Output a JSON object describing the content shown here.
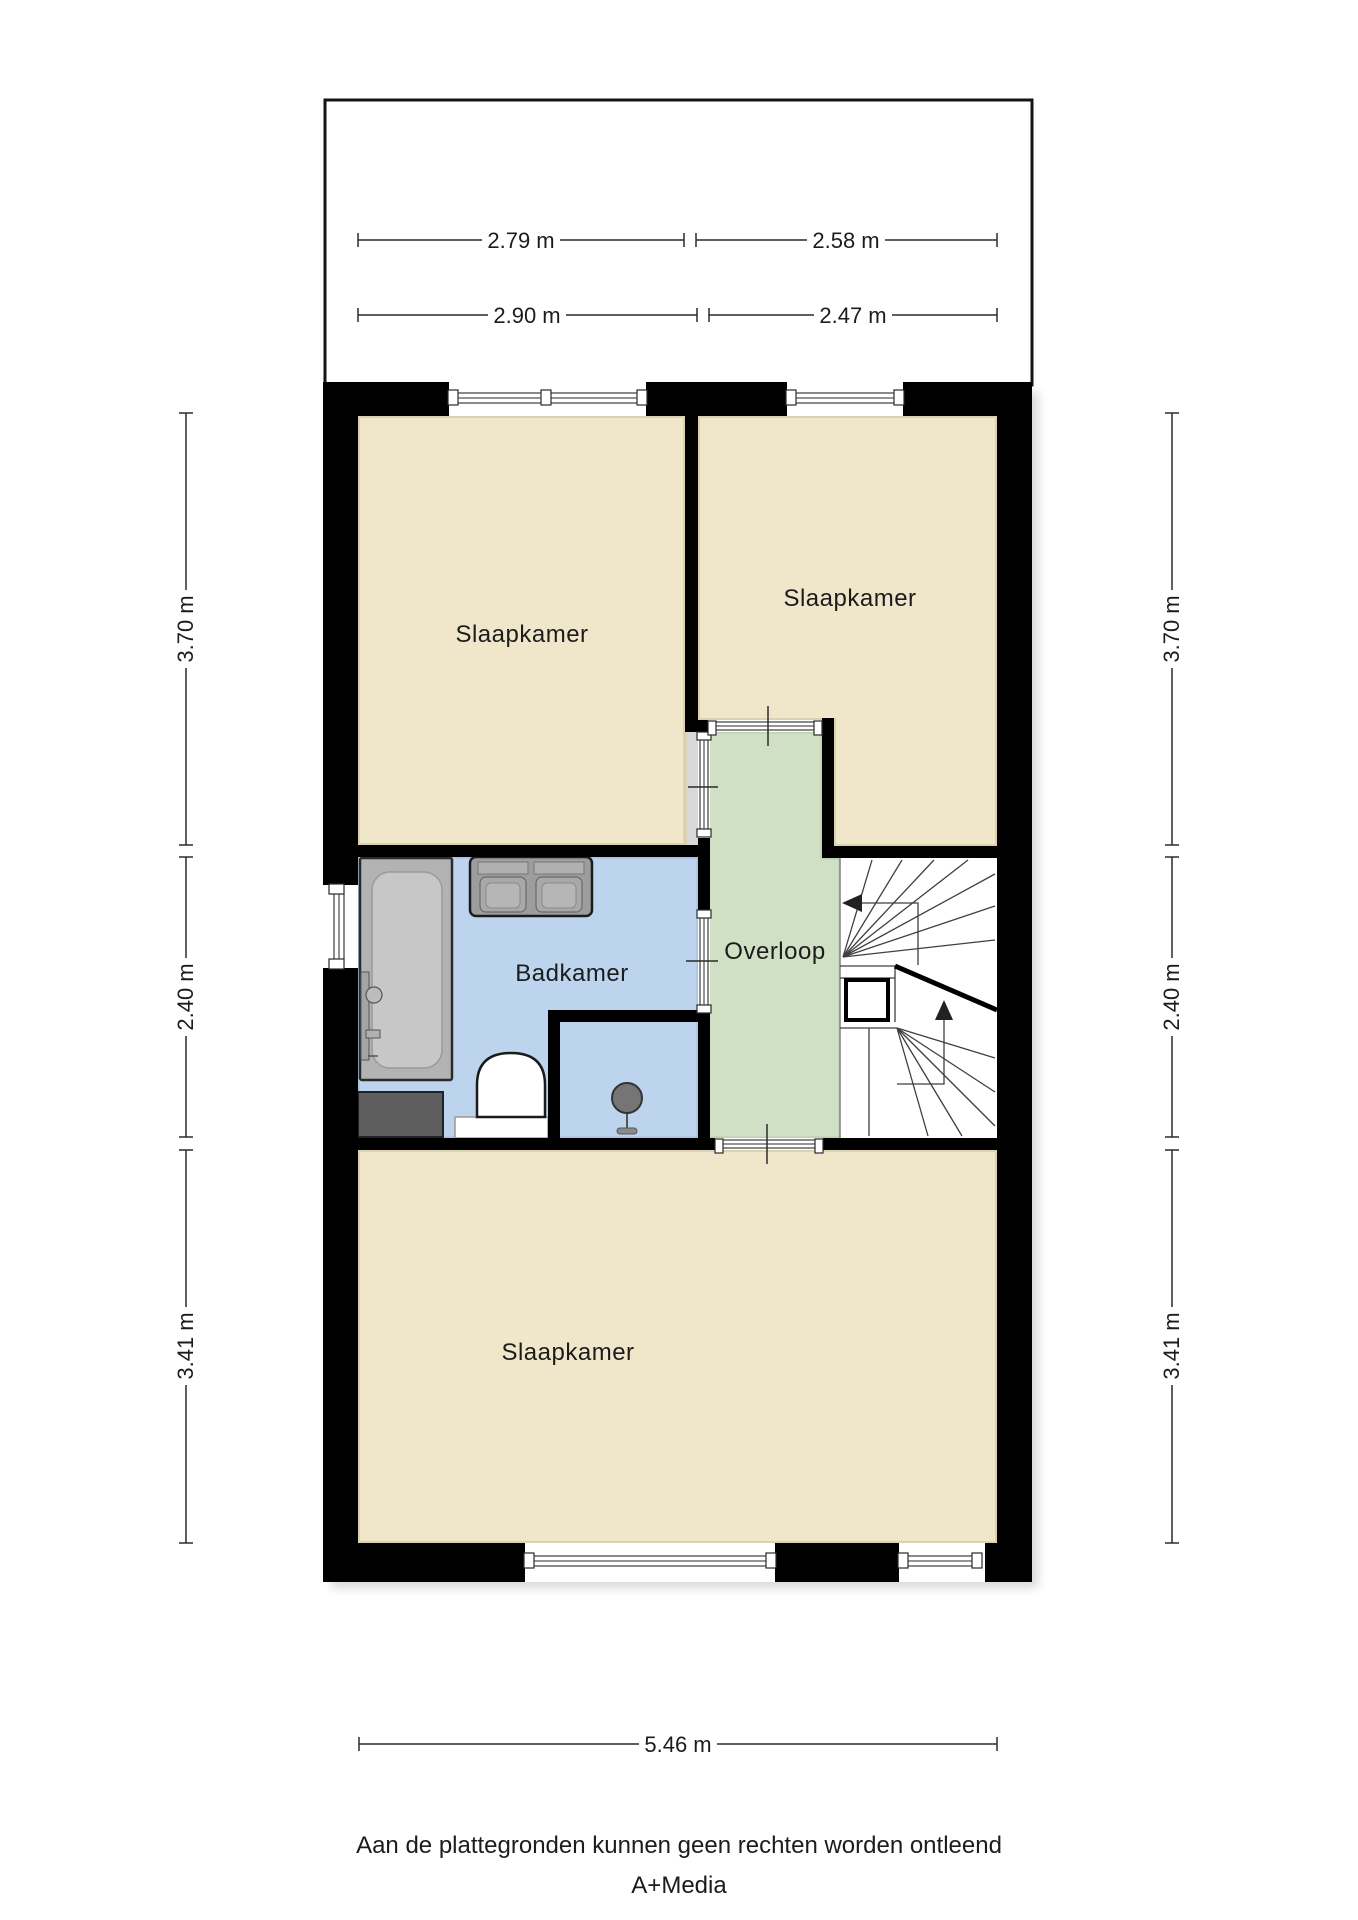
{
  "labels": {
    "slaapkamer_tl": "Slaapkamer",
    "slaapkamer_tr": "Slaapkamer",
    "badkamer": "Badkamer",
    "overloop": "Overloop",
    "slaapkamer_bottom": "Slaapkamer"
  },
  "dimensions": {
    "attic_width_1": "2.79 m",
    "attic_width_2": "2.58 m",
    "floor_width_1": "2.90 m",
    "floor_width_2": "2.47 m",
    "left_height_1": "3.70 m",
    "left_height_2": "2.40 m",
    "left_height_3": "3.41 m",
    "right_height_1": "3.70 m",
    "right_height_2": "2.40 m",
    "right_height_3": "3.41 m",
    "total_width": "5.46 m"
  },
  "footer": {
    "disclaimer": "Aan de plattegronden kunnen geen rechten worden ontleend",
    "brand": "A+Media"
  },
  "colors": {
    "wall": "#000000",
    "room_beige": "#f0e7ca",
    "room_beige_edge": "#dcd2b2",
    "wet_blue": "#bdd4ef",
    "wet_blue_edge": "#a9c0dc",
    "hall_green": "#cfe0c4",
    "hall_green_edge": "#bfd1b1",
    "fixture_gray": "#b3b3b3",
    "fixture_dark_gray": "#5e5e5e"
  }
}
